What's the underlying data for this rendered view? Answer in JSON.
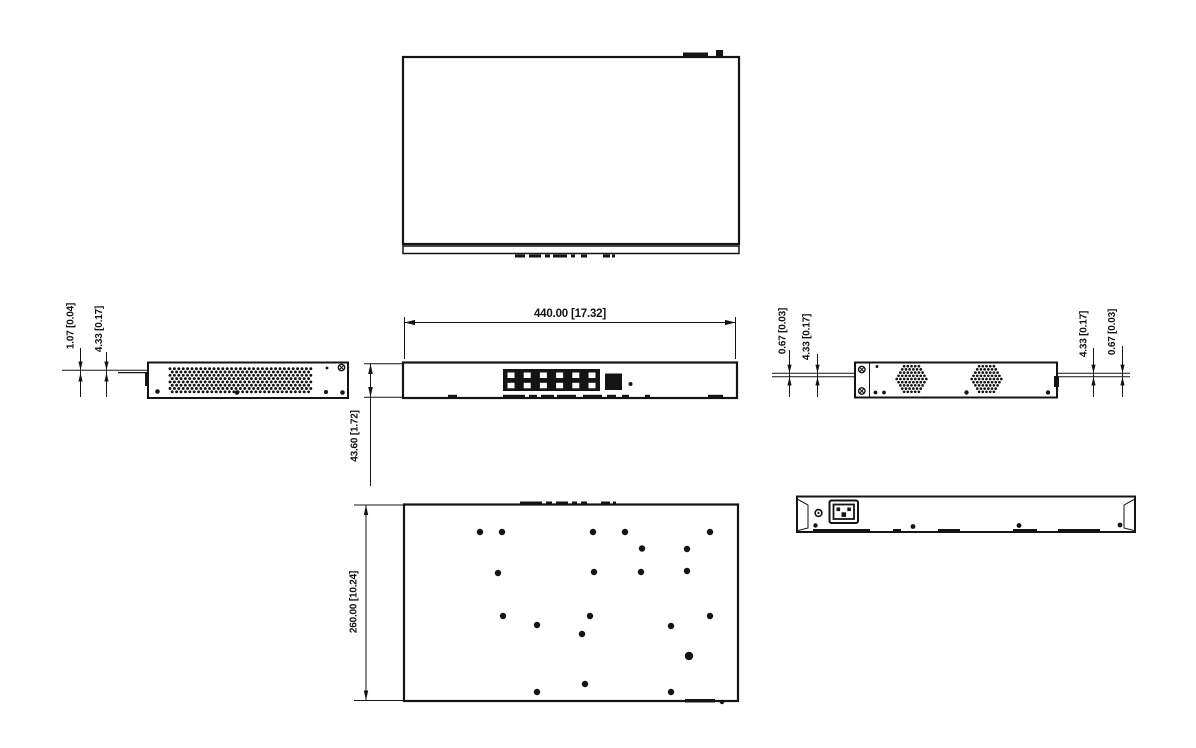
{
  "meta": {
    "background": "#ffffff",
    "line_color": "#141414",
    "drawing_type": "mechanical-dimension-drawing",
    "subject": "1U rack-mount network switch shown in five orthographic views with metric [inch] dimensions"
  },
  "dimensions": {
    "front_width": "440.00 [17.32]",
    "front_height": "43.60 [1.72]",
    "chassis_depth": "260.00 [10.24]",
    "left_side": {
      "lip": "1.07 [0.04]",
      "ear": "4.33 [0.17]"
    },
    "right_side": {
      "front_lip": "0.67 [0.03]",
      "front_ear": "4.33 [0.17]",
      "rear_ear": "4.33 [0.17]",
      "rear_lip": "0.67 [0.03]"
    }
  },
  "views": {
    "top": {
      "ticks": [
        [
          515,
          10
        ],
        [
          529,
          12
        ],
        [
          545,
          5
        ],
        [
          553,
          14
        ],
        [
          571,
          4
        ],
        [
          581,
          6
        ],
        [
          603,
          7
        ],
        [
          612,
          3
        ]
      ]
    },
    "front": {
      "port_block": {
        "x": 503,
        "y": 369,
        "w": 97,
        "h": 22,
        "rows": 2,
        "cols": 6
      },
      "bottom_ticks": [
        [
          448,
          9
        ],
        [
          503,
          22
        ],
        [
          529,
          8
        ],
        [
          541,
          13
        ],
        [
          557,
          19
        ],
        [
          583,
          19
        ],
        [
          607,
          9
        ],
        [
          622,
          7
        ],
        [
          645,
          5
        ],
        [
          708,
          15
        ]
      ]
    },
    "left_side": {
      "vent": {
        "x": 168,
        "y": 366.5,
        "w": 144,
        "h": 26
      },
      "dots": [
        [
          157.5,
          391.5,
          2.3
        ],
        [
          237,
          392.5,
          2.3
        ],
        [
          326,
          392,
          2
        ],
        [
          342.5,
          392.5,
          2.3
        ],
        [
          327,
          368,
          1.4
        ]
      ],
      "screws": [
        [
          341.5,
          367.5
        ]
      ]
    },
    "right_side": {
      "hex_vents": [
        [
          911.5,
          379
        ],
        [
          986.5,
          379
        ]
      ],
      "dots": [
        [
          877,
          366.5,
          1.5
        ],
        [
          875.5,
          392.5,
          1.9
        ],
        [
          884,
          392.5,
          1.9
        ],
        [
          966.5,
          392.5,
          2.2
        ],
        [
          1048,
          392.5,
          2.2
        ]
      ],
      "screws": [
        [
          861.8,
          369.5
        ],
        [
          861.8,
          391
        ]
      ]
    },
    "bottom": {
      "holes": [
        [
          480,
          532
        ],
        [
          502,
          532
        ],
        [
          593,
          532
        ],
        [
          625,
          532
        ],
        [
          710,
          532
        ],
        [
          642,
          548.5
        ],
        [
          687,
          549
        ],
        [
          498,
          573
        ],
        [
          594,
          572
        ],
        [
          641,
          572
        ],
        [
          687,
          571
        ],
        [
          503,
          616
        ],
        [
          590,
          616
        ],
        [
          710,
          616
        ],
        [
          537,
          625
        ],
        [
          671,
          626
        ],
        [
          582,
          634
        ],
        [
          689,
          656,
          4.2
        ],
        [
          585,
          684
        ],
        [
          537,
          692
        ],
        [
          671,
          692
        ]
      ],
      "top_ticks": [
        [
          520,
          22
        ],
        [
          546,
          6
        ],
        [
          556,
          12
        ],
        [
          572,
          5
        ],
        [
          581,
          6
        ],
        [
          601,
          9
        ],
        [
          613,
          3
        ]
      ]
    },
    "rear": {
      "bottom_dots": [
        [
          815.5,
          525.5,
          2.2
        ],
        [
          913,
          526.5,
          2.4
        ],
        [
          1019,
          525.5,
          2.4
        ],
        [
          1120,
          525,
          2.4
        ]
      ],
      "ticks": [
        [
          813,
          57
        ],
        [
          893,
          8
        ],
        [
          938,
          22
        ],
        [
          1013,
          24
        ],
        [
          1058,
          42
        ]
      ]
    }
  }
}
